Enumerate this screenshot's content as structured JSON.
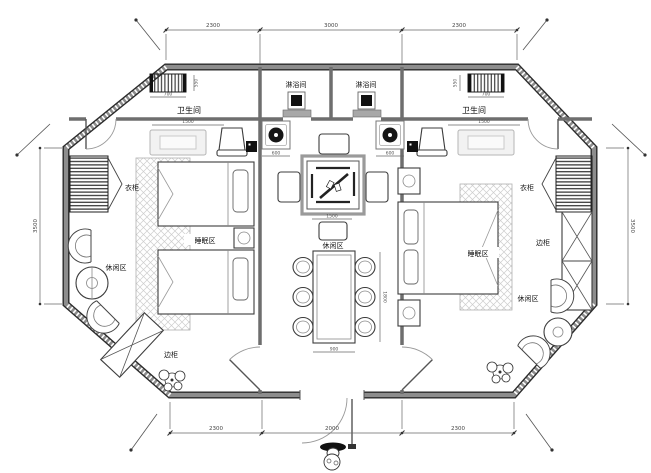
{
  "labels": {
    "shower_left": "淋浴间",
    "shower_right": "淋浴间",
    "toilet_left": "卫生间",
    "toilet_right": "卫生间",
    "wardrobe_left": "衣柜",
    "wardrobe_right": "衣柜",
    "sleeping_left": "睡眠区",
    "sleeping_right": "睡眠区",
    "lounge_left": "休闲区",
    "lounge_center": "休闲区",
    "lounge_right": "休闲区",
    "cabinet_left": "边柜",
    "cabinet_right": "边柜"
  },
  "dimensions": {
    "top": [
      "2300",
      "3000",
      "2300"
    ],
    "bottom": [
      "2300",
      "2000",
      "2300"
    ],
    "left_side": "3500",
    "right_side": "3500",
    "vanity_left_w": "700",
    "vanity_left_d": "550",
    "vanity_right_w": "700",
    "vanity_right_d": "550",
    "bath_left_w": "1500",
    "bath_right_w": "1500",
    "basin_left": "600",
    "basin_right": "600",
    "game_table_w": "1500",
    "dining_w": "900",
    "dining_l": "1800"
  }
}
